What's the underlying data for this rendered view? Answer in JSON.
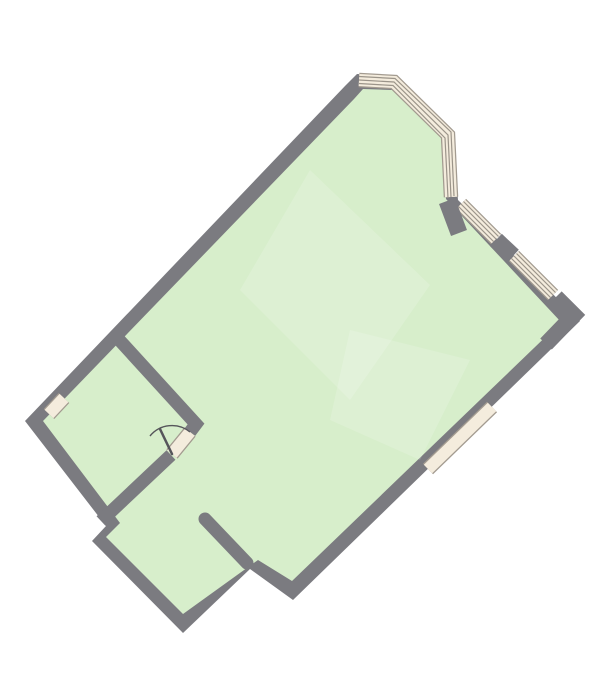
{
  "plan": {
    "kind": "apartment-floor-plan",
    "rooms": [
      "main-room",
      "side-room",
      "lower-room"
    ],
    "features": [
      "corner-bay-window",
      "window-upper-right-1",
      "window-upper-right-2",
      "window-lower-right",
      "window-left",
      "interior-door-with-swing-arc",
      "wall-stub-passage"
    ]
  },
  "colors": {
    "background": "#ffffff",
    "wall": "#7b7b80",
    "floor": "#d7eecb",
    "floor_highlight": "#ffffff",
    "window_fill": "#f4ecdd",
    "window_frame": "#a39b90",
    "window_line": "#9b9489",
    "door": "#55555a"
  },
  "paths": {
    "outer": "M345,86 L357,74 L396,76 L452,132 L458,200 L580,321 L293,600 L250,569 L183,633 L92,541 L106,526 L25,421 Z",
    "floor": "M354,99 L363,89 L392,90 L441,138 L446,199 L561,322 L292,581 L258,560 L183,614 L106,537 L120,523 L43,421 Z",
    "streak1": "M310,170 L430,285 L350,400 L240,290 Z",
    "streak2": "M350,330 L470,360 L420,460 L330,420 Z",
    "wall_w1": "M112,332 L196,424 L190,432",
    "wall_left_bottom": "M171,455 L101,521",
    "wall_stub": "M205,519 L247,563",
    "pier_1": "M447,201 L459,233",
    "pier_2": "M496,240 L513,256",
    "corner_ne": "M556,297 L574,315 L546,344",
    "bay_band": "M359,80 L394,82 L448,135 L451,197",
    "bay_line_1": "M359,76.5 L395,78.5 L451,132 L454,196",
    "bay_line_2": "M359,83.5 L393,85.5 L445,138 L448,198",
    "window_a": "M461,204 L496,239",
    "window_a_line_1": "M458.5,206.5 L493.5,241.5",
    "window_a_line_2": "M463.5,201.5 L498.5,236.5",
    "window_b": "M514,256 L553,295",
    "window_b_line_1": "M511.5,258.5 L550.5,297.5",
    "window_b_line_2": "M516.5,253.5 L555.5,292.5",
    "window_c": "M492,407 L428,469",
    "window_d": "M64,398 L49,414",
    "door_threshold": "M190,432 L172,454",
    "door_arc": "M190,432 A28.4,28.4 0 0 0 150,436",
    "door_leaf": "M172,454 L160,429"
  }
}
